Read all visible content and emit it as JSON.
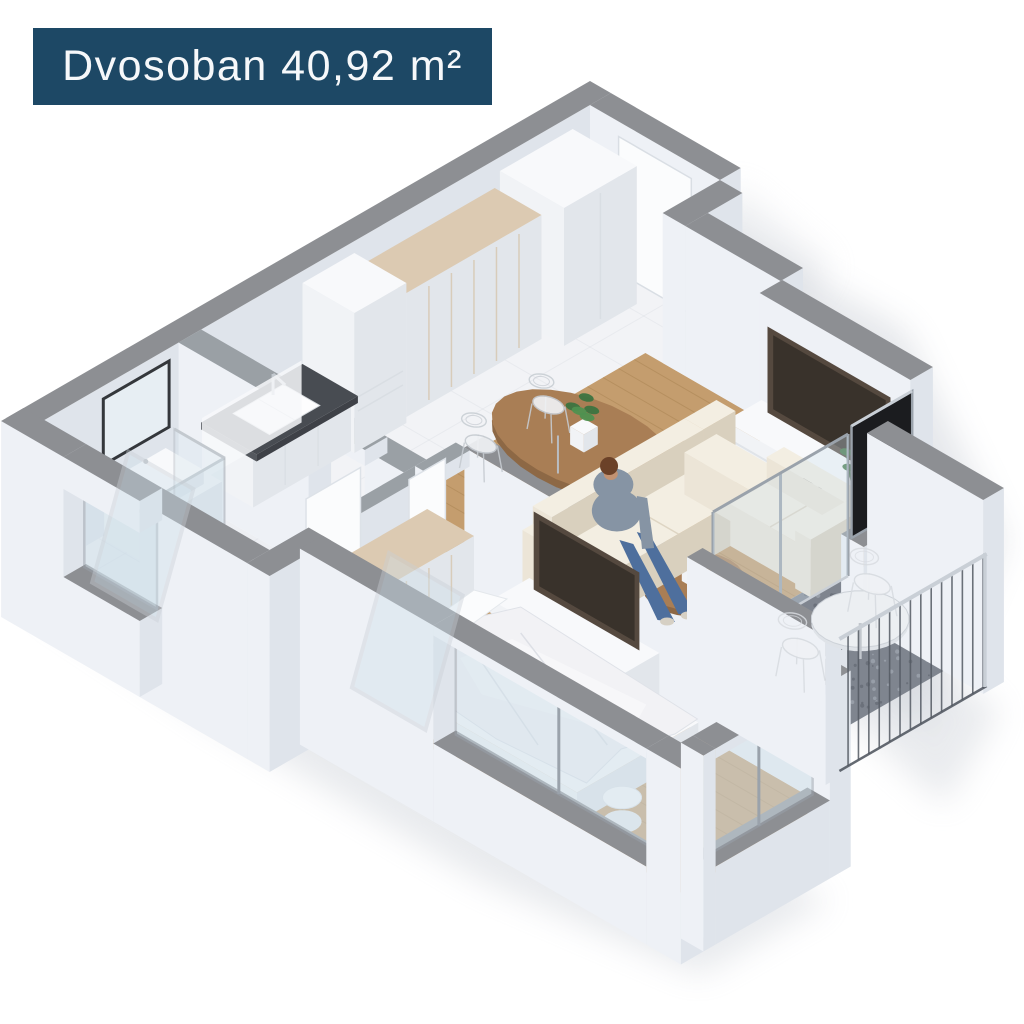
{
  "title_badge": {
    "text": "Dvosoban 40,92 m²",
    "apartment_type": "Dvosoban",
    "area": "40,92 m²",
    "background": "#1d4865",
    "text_color": "#f6f8fa"
  },
  "scene": {
    "type": "isometric-3d-floor-plan-render",
    "background": "#ffffff",
    "rooms": [
      {
        "name": "entrance-hall",
        "floor": "marble",
        "furniture": [
          "entrance-door",
          "tall-cabinet",
          "wardrobe"
        ]
      },
      {
        "name": "kitchen",
        "floor": "marble",
        "furniture": [
          "fridge",
          "counter-with-sink",
          "dark-countertop"
        ]
      },
      {
        "name": "dining-area",
        "floor": "wood",
        "furniture": [
          "oval-dining-table",
          "wire-chairs",
          "potted-plant"
        ]
      },
      {
        "name": "living-room",
        "floor": "wood",
        "furniture": [
          "tv-console",
          "tv",
          "corner-sofa",
          "seated-person",
          "coffee-table",
          "floor-plant",
          "balcony-glass-doors"
        ]
      },
      {
        "name": "bathroom",
        "floor": "marble",
        "furniture": [
          "vanity",
          "mirror",
          "wall-hung-toilet",
          "walk-in-shower",
          "small-window"
        ]
      },
      {
        "name": "bedroom",
        "floor": "wood",
        "furniture": [
          "double-bed",
          "wardrobe",
          "tv-console",
          "tv",
          "stool",
          "corner-windows"
        ]
      },
      {
        "name": "balcony",
        "floor": "speckled-stone",
        "furniture": [
          "round-table",
          "wire-chairs",
          "metal-railing"
        ]
      }
    ],
    "palette": {
      "wall_top": "#8d8f93",
      "wall_top_inner": "#9aa0a5",
      "wall_light": "#eef1f6",
      "wall_shade": "#dfe4eb",
      "white_top": "#f8f9fb",
      "white_light": "#f1f3f6",
      "white_shade": "#e2e6eb",
      "wood": "#c49d6e",
      "wood_dark": "#ab8254",
      "plank": "#96723f",
      "marble": "#f2f3f6",
      "marble_line": "#c6cbd4",
      "bath_floor": "#edeff3",
      "balcony_floor": "#7f858f",
      "speckle_dark": "#666c76",
      "speckle_light": "#9da4ae",
      "counter": "#484c52",
      "wardrobe_top": "#dccab2",
      "table_wood": "#a97e55",
      "table_wood_dark": "#8d6845",
      "sofa": "#ece5d7",
      "sofa_shade": "#d9d0be",
      "sofa_top": "#f3eee2",
      "tv": "#55493f",
      "tv_screen": "#39322b",
      "glass": "#cfe0ea",
      "glass_dark": "#1b1c1f",
      "frame": "#9aa2ab",
      "frame_light": "#c9cfd6",
      "chrome": "#c3c9cf",
      "mirror_frame": "#2b2e32",
      "door": "#fbfcfd",
      "plant": "#4f9150",
      "plant_dark": "#3c7440",
      "railing": "#545a63",
      "shadow": "#c9ced5",
      "skin": "#c29272",
      "hair": "#6b4128",
      "shirt": "#8694a4",
      "jeans": "#4e6f9d",
      "shoe": "#d6d0c4"
    }
  }
}
